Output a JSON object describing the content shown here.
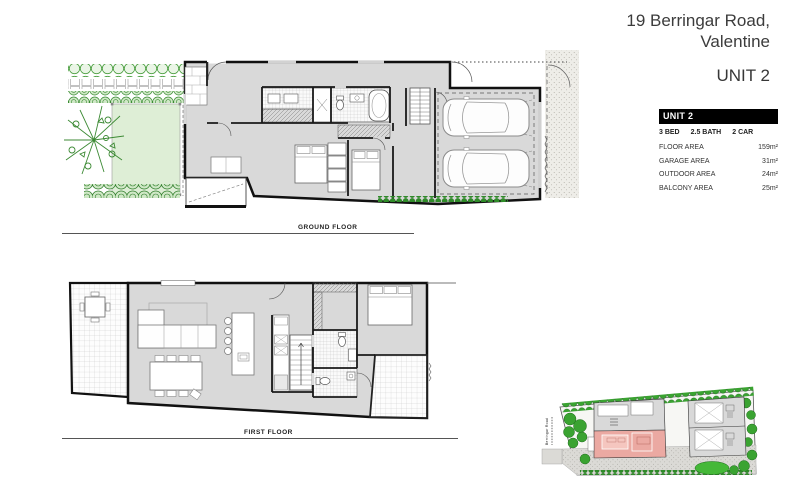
{
  "header": {
    "address_line1": "19 Berringar Road,",
    "address_line2": "Valentine",
    "unit": "UNIT 2"
  },
  "info_panel": {
    "title": "UNIT 2",
    "specs": [
      "3 BED",
      "2.5 BATH",
      "2 CAR"
    ],
    "areas": [
      {
        "label": "FLOOR AREA",
        "value": "159m²"
      },
      {
        "label": "GARAGE AREA",
        "value": "31m²"
      },
      {
        "label": "OUTDOOR AREA",
        "value": "24m²"
      },
      {
        "label": "BALCONY AREA",
        "value": "25m²"
      }
    ],
    "header_bg": "#000000",
    "header_text_color": "#ffffff"
  },
  "floor_plans": {
    "ground": {
      "label": "GROUND FLOOR"
    },
    "first": {
      "label": "FIRST FLOOR"
    }
  },
  "site_plan": {
    "road_label": "Berringar Road",
    "highlight_color": "#eba9a2"
  },
  "colors": {
    "plan_fill": "#d9d9d9",
    "lawn_green": "#deeed6",
    "landscape_green": "#3aa331",
    "hedge_green": "#2f8c28"
  }
}
